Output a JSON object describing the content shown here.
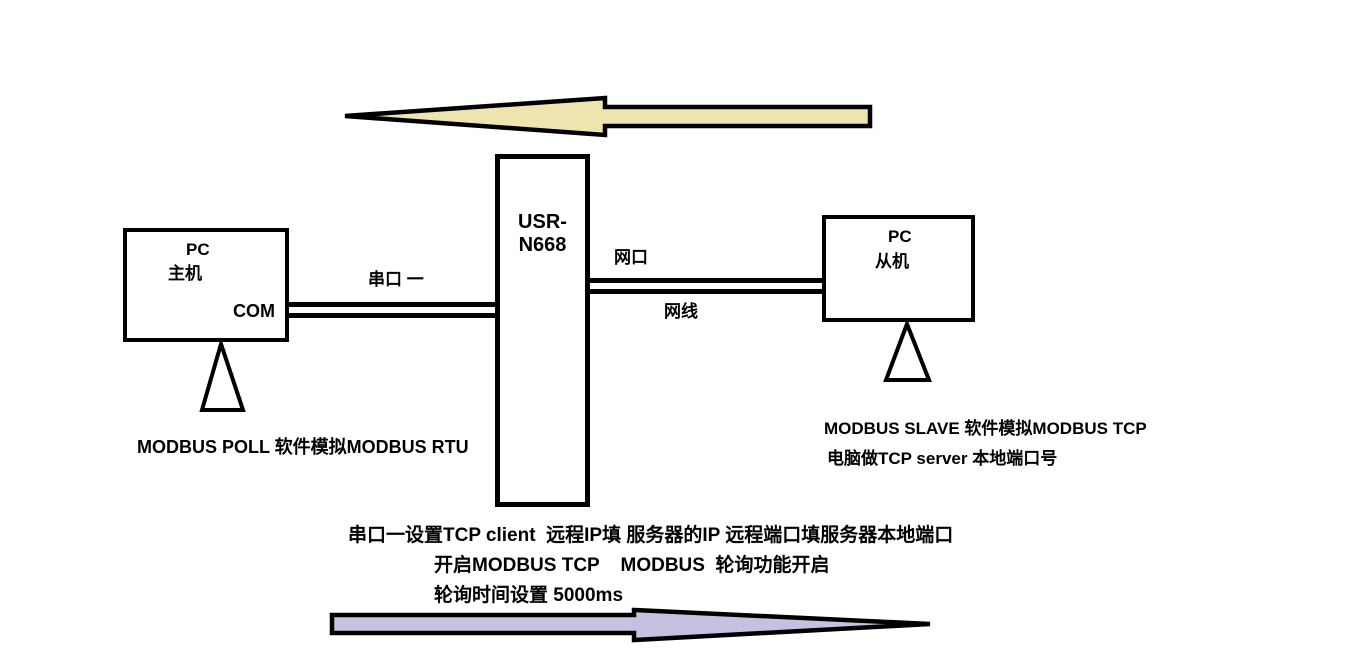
{
  "colors": {
    "top_arrow_fill": "#EDE4AF",
    "bottom_arrow_fill": "#C6C1E0",
    "outline": "#000000",
    "triangle_fill": "#FFFFFF"
  },
  "device": {
    "label": "USR-N668"
  },
  "left_pc": {
    "title": "PC",
    "role": "主机",
    "port": "COM"
  },
  "right_pc": {
    "title": "PC",
    "role": "从机"
  },
  "links": {
    "serial": {
      "label": "串口 一"
    },
    "ethernet": {
      "port_label": "网口",
      "cable_label": "网线"
    }
  },
  "notes": {
    "left": "MODBUS POLL 软件模拟MODBUS RTU",
    "right_line1": "MODBUS SLAVE 软件模拟MODBUS TCP",
    "right_line2": "电脑做TCP server 本地端口号",
    "bottom": [
      "串口一设置TCP client  远程IP填 服务器的IP 远程端口填服务器本地端口",
      "开启MODBUS TCP    MODBUS  轮询功能开启",
      "轮询时间设置 5000ms"
    ]
  },
  "arrows": {
    "top": {
      "direction": "left"
    },
    "bottom": {
      "direction": "right"
    }
  }
}
